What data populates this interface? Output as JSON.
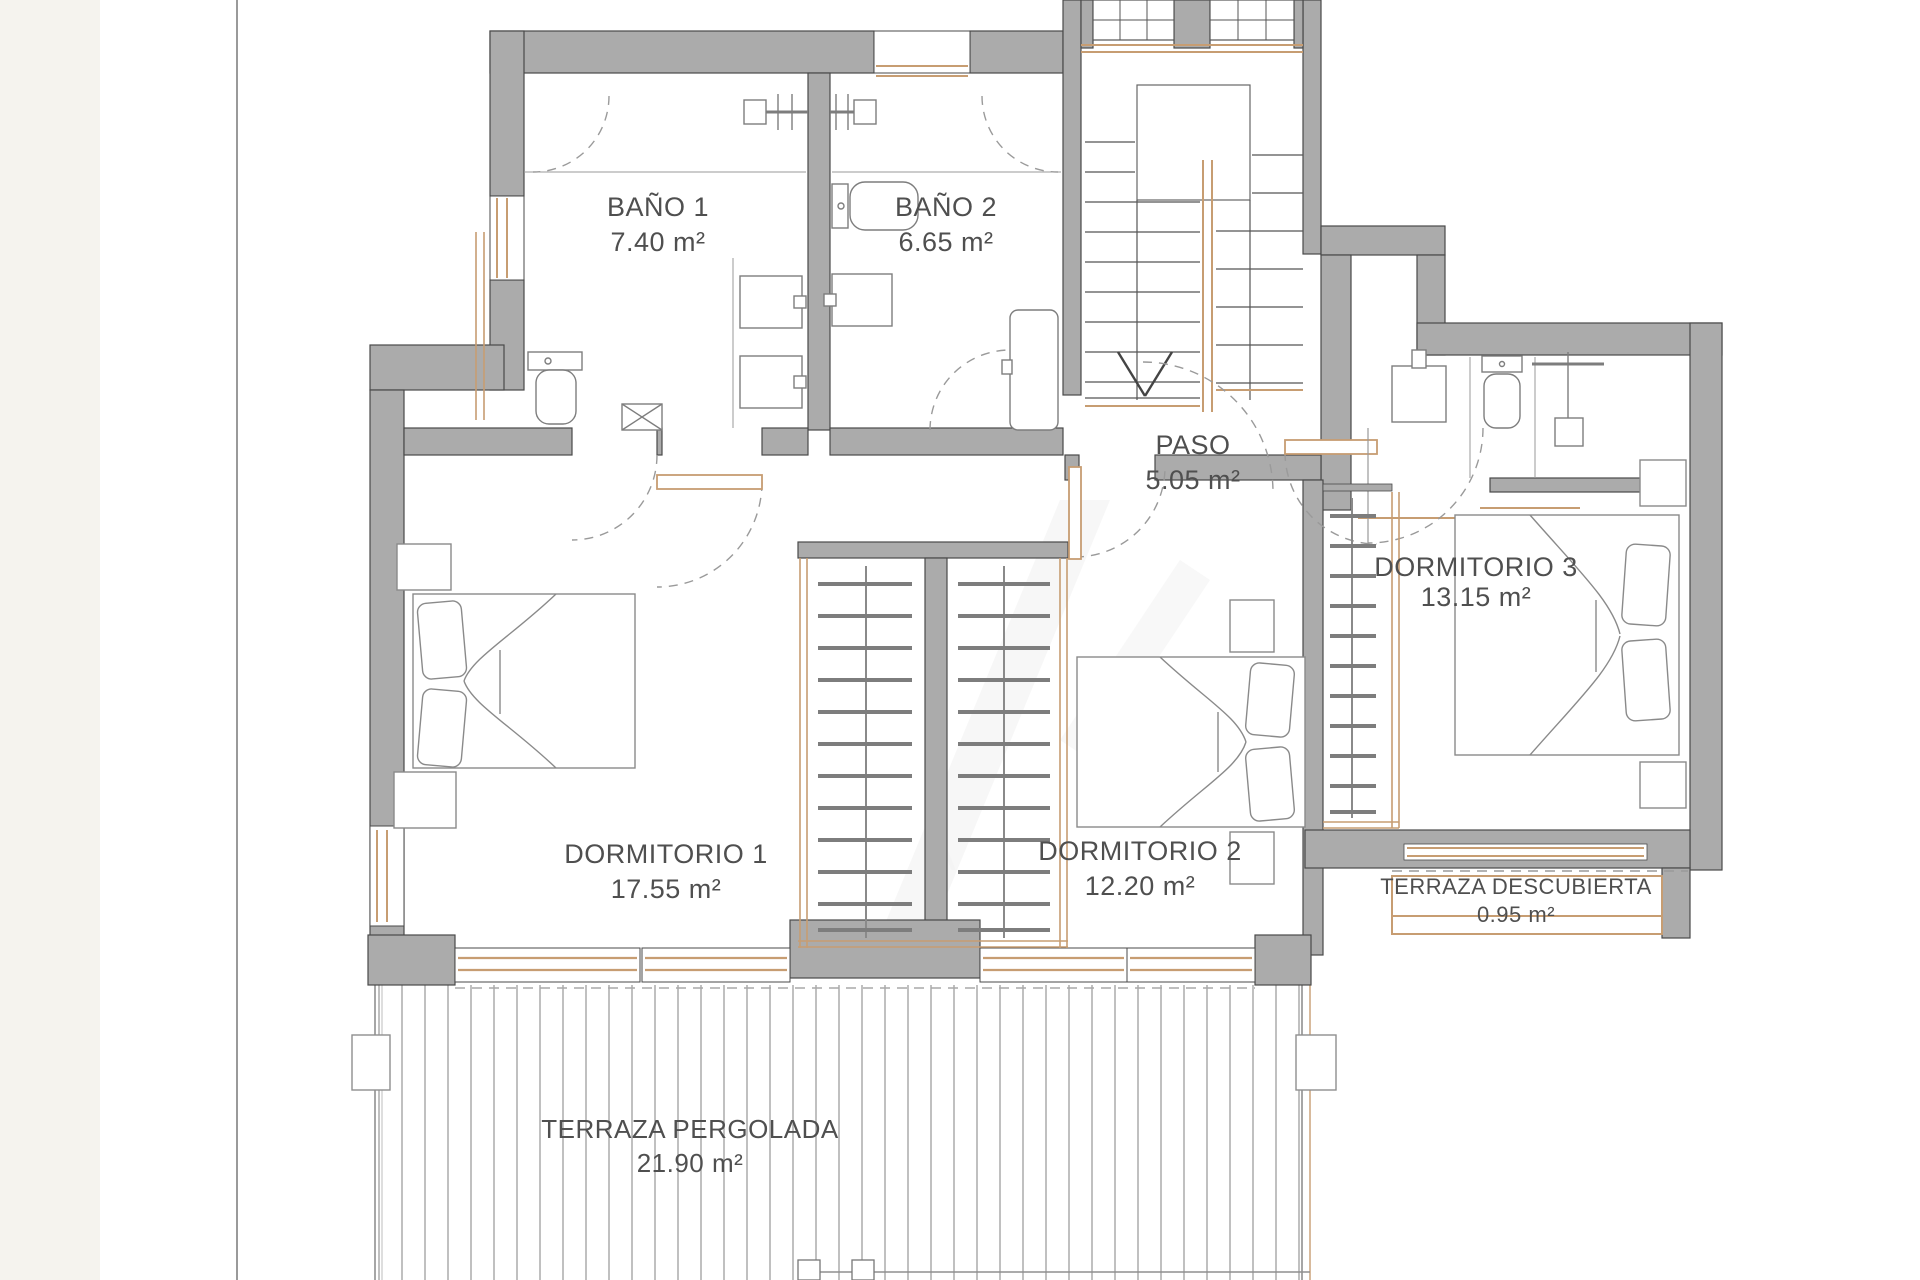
{
  "plan": {
    "title_hint": "upper floor plan",
    "rooms": [
      {
        "id": "bano-1",
        "name": "BAÑO 1",
        "area": "7.40 m²"
      },
      {
        "id": "bano-2",
        "name": "BAÑO 2",
        "area": "6.65 m²"
      },
      {
        "id": "paso",
        "name": "PASO",
        "area": "5.05 m²"
      },
      {
        "id": "dormitorio-1",
        "name": "DORMITORIO 1",
        "area": "17.55 m²"
      },
      {
        "id": "dormitorio-2",
        "name": "DORMITORIO 2",
        "area": "12.20 m²"
      },
      {
        "id": "dormitorio-3",
        "name": "DORMITORIO 3",
        "area": "13.15 m²"
      },
      {
        "id": "terraza-descubierta",
        "name": "TERRAZA DESCUBIERTA",
        "area": "0.95 m²"
      },
      {
        "id": "terraza-pergolada",
        "name": "TERRAZA PERGOLADA",
        "area": "21.90 m²"
      }
    ],
    "colors": {
      "wall": "#ababab",
      "wall_outline": "#4a4a4a",
      "wood": "#c79d72",
      "text": "#4f4f4f",
      "paper_margin": "#f5f3ee"
    }
  }
}
